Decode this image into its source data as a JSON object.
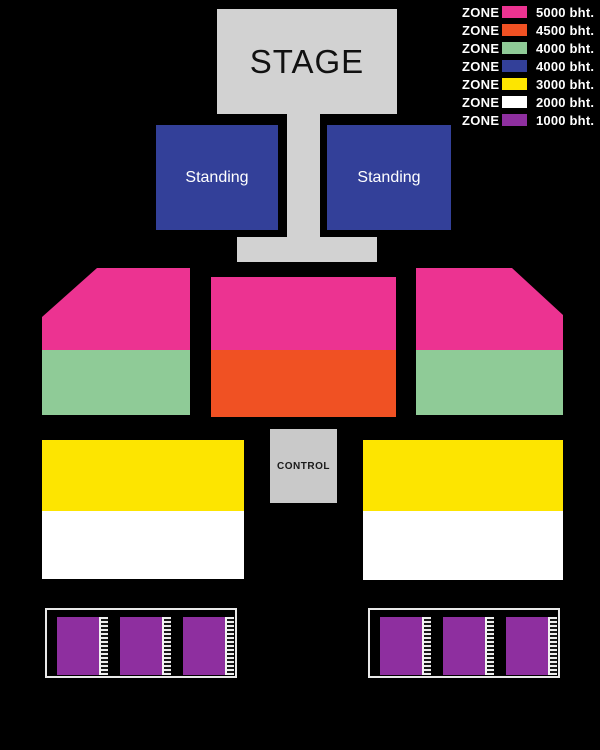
{
  "legend": {
    "zone_label": "ZONE",
    "items": [
      {
        "name": "zone-5000",
        "price": "5000 bht.",
        "color": "#EC3391"
      },
      {
        "name": "zone-4500",
        "price": "4500 bht.",
        "color": "#F05123"
      },
      {
        "name": "zone-4000-seated",
        "price": "4000 bht.",
        "color": "#8FCB97"
      },
      {
        "name": "zone-4000-standing",
        "price": "4000 bht.",
        "color": "#334099"
      },
      {
        "name": "zone-3000",
        "price": "3000 bht.",
        "color": "#FDE500"
      },
      {
        "name": "zone-2000",
        "price": "2000 bht.",
        "color": "#FFFFFF"
      },
      {
        "name": "zone-1000",
        "price": "1000 bht.",
        "color": "#8E2F9F"
      }
    ]
  },
  "stage": {
    "label": "STAGE"
  },
  "standing": {
    "left_label": "Standing",
    "right_label": "Standing"
  },
  "control": {
    "label": "CONTROL"
  },
  "colors": {
    "background": "#000000",
    "stage_gray": "#D2D2D2",
    "control_gray": "#C9C9C9",
    "pink": "#EC3391",
    "orange": "#F05123",
    "green": "#8FCB97",
    "blue": "#334099",
    "yellow": "#FDE500",
    "white": "#FFFFFF",
    "purple": "#8E2F9F"
  }
}
